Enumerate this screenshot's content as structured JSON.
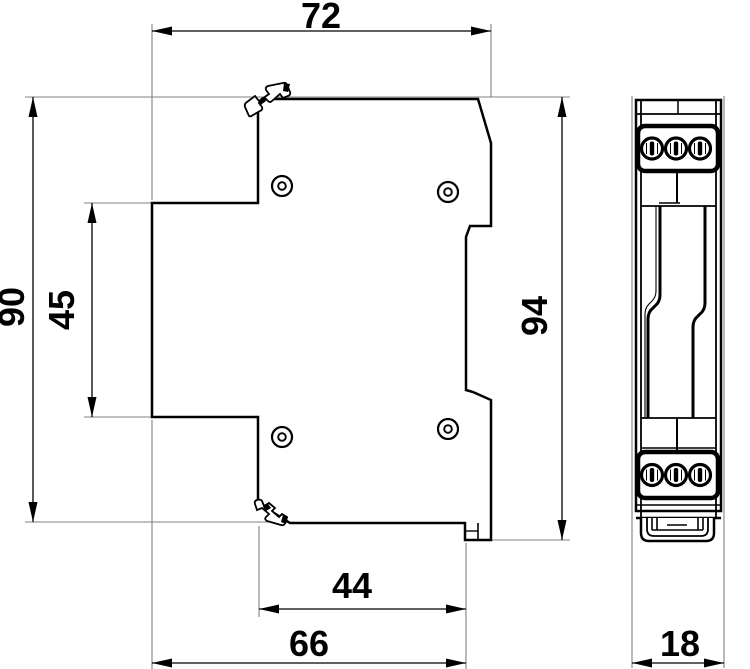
{
  "page": {
    "background": "#ffffff"
  },
  "drawing": {
    "type": "technical-dimension-drawing",
    "line_color": "#000000",
    "extension_line_color": "#808080",
    "dimensions": {
      "top_width": "72",
      "body_height": "90",
      "step_height": "45",
      "overall_height": "94",
      "lower_width": "44",
      "base_width": "66",
      "module_width": "18"
    }
  }
}
